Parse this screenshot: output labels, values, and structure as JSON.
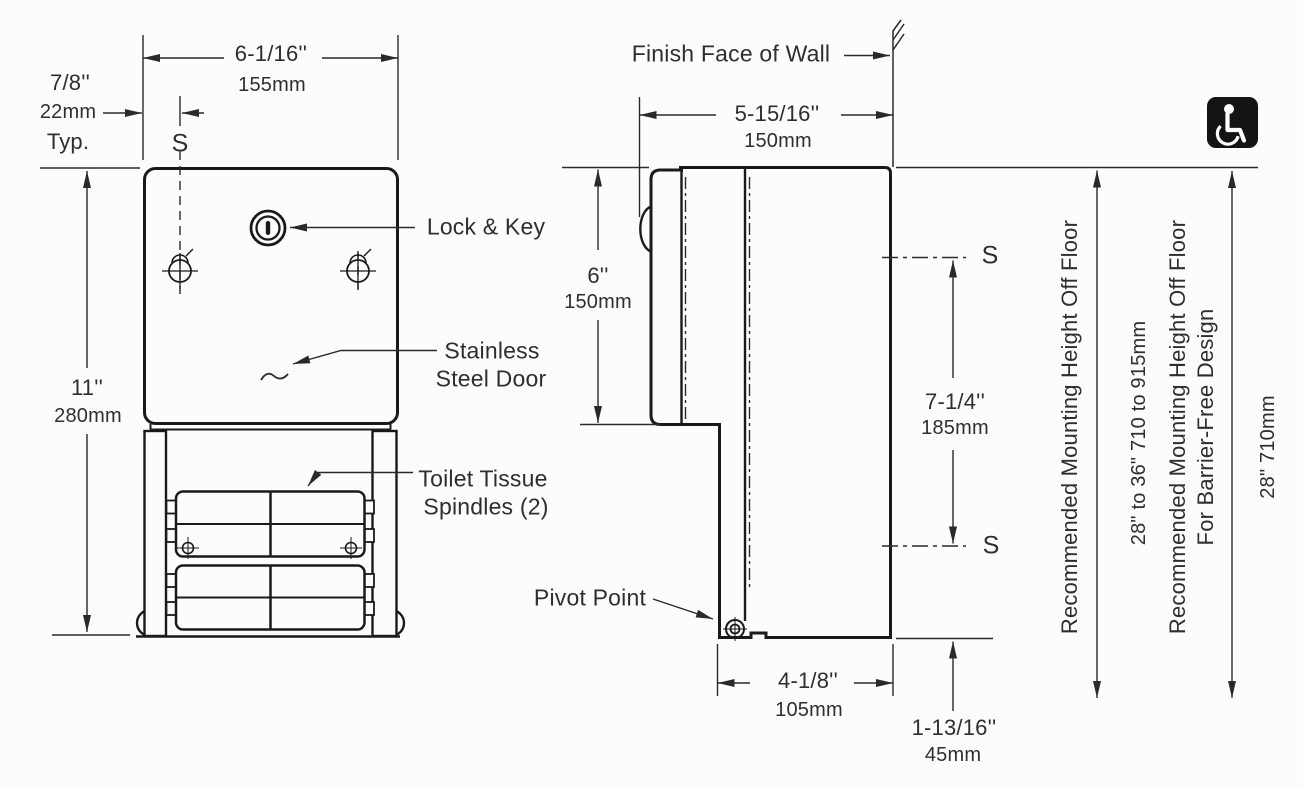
{
  "title": "toilet-tissue-dispenser-spec-drawing",
  "colors": {
    "object_line": "#1a1a1a",
    "dimension_line": "#2a2a2a",
    "text": "#2e2e2e",
    "background": "#fcfcfc",
    "icon_background": "#141414",
    "icon_glyph": "#ffffff"
  },
  "front_view": {
    "s_label": "S",
    "width_dim": {
      "inches": "6-1/16''",
      "metric": "155mm"
    },
    "offset_dim": {
      "inches": "7/8''",
      "metric": "22mm",
      "qualifier": "Typ."
    },
    "height_dim": {
      "inches": "11''",
      "metric": "280mm"
    },
    "lock_label": "Lock & Key",
    "door_label": {
      "line1": "Stainless",
      "line2": "Steel Door"
    },
    "spindles_label": {
      "line1": "Toilet Tissue",
      "line2": "Spindles (2)"
    }
  },
  "side_view": {
    "wall_label": "Finish Face of Wall",
    "depth_dim": {
      "inches": "5-15/16''",
      "metric": "150mm"
    },
    "upper_height_dim": {
      "inches": "6''",
      "metric": "150mm"
    },
    "s_upper_label": "S",
    "s_lower_label": "S",
    "spindle_spacing_dim": {
      "inches": "7-1/4''",
      "metric": "185mm"
    },
    "pivot_label": "Pivot Point",
    "lower_depth_dim": {
      "inches": "4-1/8''",
      "metric": "105mm"
    },
    "bottom_offset_dim": {
      "inches": "1-13/16''",
      "metric": "45mm"
    }
  },
  "mounting_notes": {
    "standard": {
      "label": "Recommended Mounting Height Off Floor",
      "range": "28\" to 36\"  710 to 915mm"
    },
    "barrier_free": {
      "label_line1": "Recommended Mounting Height Off Floor",
      "label_line2": "For Barrier-Free Design",
      "range": "28\"  710mm"
    }
  },
  "icons": {
    "accessibility": "wheelchair-accessibility"
  }
}
